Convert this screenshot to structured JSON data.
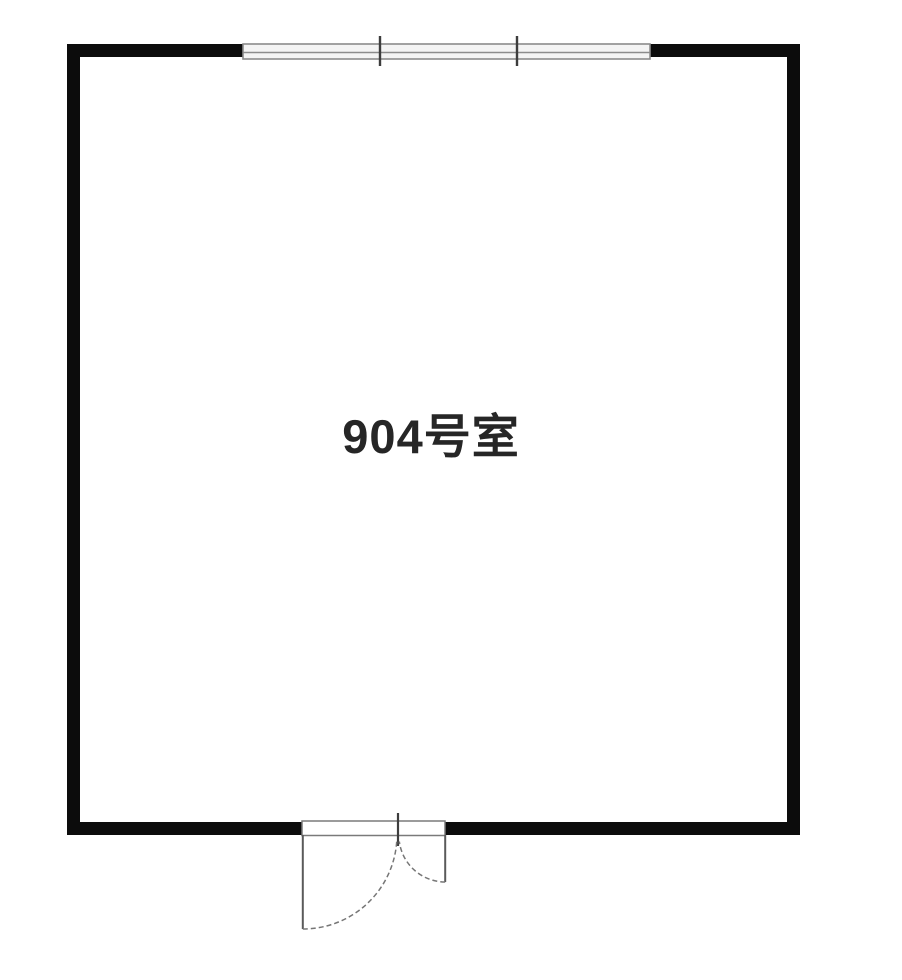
{
  "room": {
    "label": "904号室"
  },
  "plan": {
    "type": "floor-plan",
    "colors": {
      "background": "#ffffff",
      "wall": "#0c0c0c",
      "thin_line": "#7a7a7a",
      "tick": "#3d3d3d",
      "label_text": "#262626"
    },
    "features": {
      "window": "three-pane-window-top-wall",
      "door": "unequal-double-swing-door-bottom-wall"
    }
  }
}
